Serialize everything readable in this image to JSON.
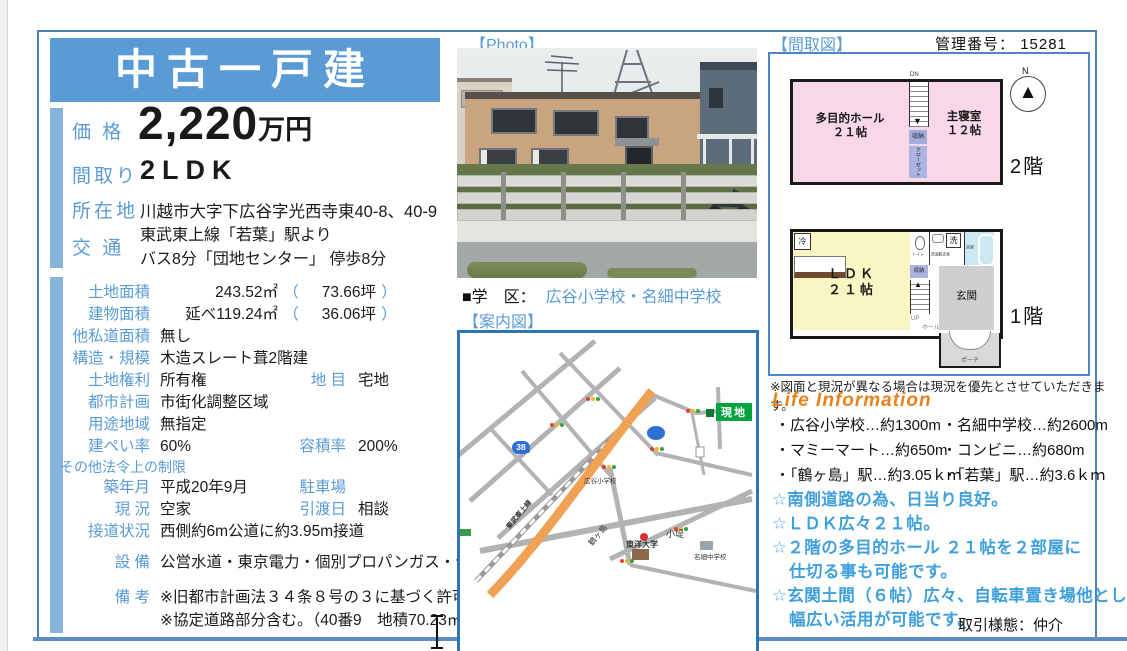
{
  "header": {
    "title": "中古一戸建"
  },
  "summary": {
    "price_label": "価 格",
    "price_value": "2,220",
    "price_unit": "万円",
    "layout_label": "間取り",
    "layout_value": "2LDK",
    "location_label": "所在地",
    "location_value": "川越市大字下広谷字光西寺東40-8、40-9",
    "access_label": "交 通",
    "access_line1": "東武東上線「若葉」駅より",
    "access_line2": "バス8分「団地センター」 停歩8分"
  },
  "details": {
    "paren_open": "（",
    "paren_close": "）",
    "rows": [
      {
        "label": "土地面積",
        "value": "243.52㎡",
        "tsubo": "73.66坪"
      },
      {
        "label": "建物面積",
        "value": "延べ119.24㎡",
        "tsubo": "36.06坪"
      },
      {
        "label": "他私道面積",
        "value": "無し"
      },
      {
        "label": "構造・規模",
        "value": "木造スレート葺2階建"
      },
      {
        "label": "土地権利",
        "value": "所有権",
        "label2": "地 目",
        "value2": "宅地"
      },
      {
        "label": "都市計画",
        "value": "市街化調整区域"
      },
      {
        "label": "用途地域",
        "value": "無指定"
      },
      {
        "label": "建ぺい率",
        "value": "60%",
        "label2": "容積率",
        "value2": "200%"
      },
      {
        "label": "その他法令上の制限"
      },
      {
        "label": "築年月",
        "value": "平成20年9月",
        "label2": "駐車場",
        "value2": ""
      },
      {
        "label": "現 況",
        "value": "空家",
        "label2": "引渡日",
        "value2": "相談"
      },
      {
        "label": "接道状況",
        "value": "西側約6m公道に約3.95m接道"
      }
    ],
    "equipment_label": "設 備",
    "equipment_value": "公営水道・東京電力・個別プロパンガス・合併浄化槽",
    "remarks_label": "備 考",
    "remarks_line1": "※旧都市計画法３４条８号の３に基づく許可",
    "remarks_line2": "※協定道路部分含む。（40番9　地積70.23㎡）"
  },
  "photo": {
    "label": "【Photo】",
    "school_label": "■学　区：",
    "school_value": "広谷小学校・名細中学校",
    "guide_label": "【案内図】"
  },
  "floorplan": {
    "label": "【間取図】",
    "kanri_label": "管理番号：",
    "kanri_no": "15281",
    "north": "N",
    "dn": "DN",
    "up": "UP",
    "hall2f_1": "多目的ホール",
    "hall2f_2": "２１帖",
    "master_1": "主寝室",
    "master_2": "１２帖",
    "storage": "収納",
    "closet": "クローゼット",
    "floor2": "2階",
    "floor1": "1階",
    "ldk_1": "ＬＤＫ",
    "ldk_2": "２１帖",
    "fridge": "冷",
    "toilet": "トイレ",
    "washroom": "洗面脱衣室",
    "laundry": "洗",
    "bath": "浴室",
    "hall1f": "ホール",
    "entrance": "玄関",
    "porch": "ポーチ",
    "note": "※図面と現況が異なる場合は現況を優先とさせていただきます。"
  },
  "life": {
    "title": "Life Information",
    "items": [
      "・広谷小学校…約1300m",
      "・名細中学校…約2600m",
      "・マミーマート…約650m",
      "・コンビニ…約680m",
      "・「鶴ヶ島」駅…約3.05ｋｍ",
      "・「若葉」駅…約3.6ｋｍ"
    ],
    "points": [
      "☆南側道路の為、日当り良好。",
      "☆ＬＤＫ広々２１帖。",
      "☆２階の多目的ホール ２１帖を２部屋に",
      "　仕切る事も可能です。",
      "☆玄関土間（６帖）広々、自転車置き場他として",
      "　幅広い活用が可能です。"
    ]
  },
  "map": {
    "site": "現地",
    "badge": "38",
    "rail": "東武東上線",
    "station": "鶴ヶ島",
    "univ": "東洋大学",
    "spot": "小堤",
    "junior": "名細中学校",
    "elem": "広谷小学校"
  },
  "footer": {
    "deal": "取引様態：仲介"
  }
}
